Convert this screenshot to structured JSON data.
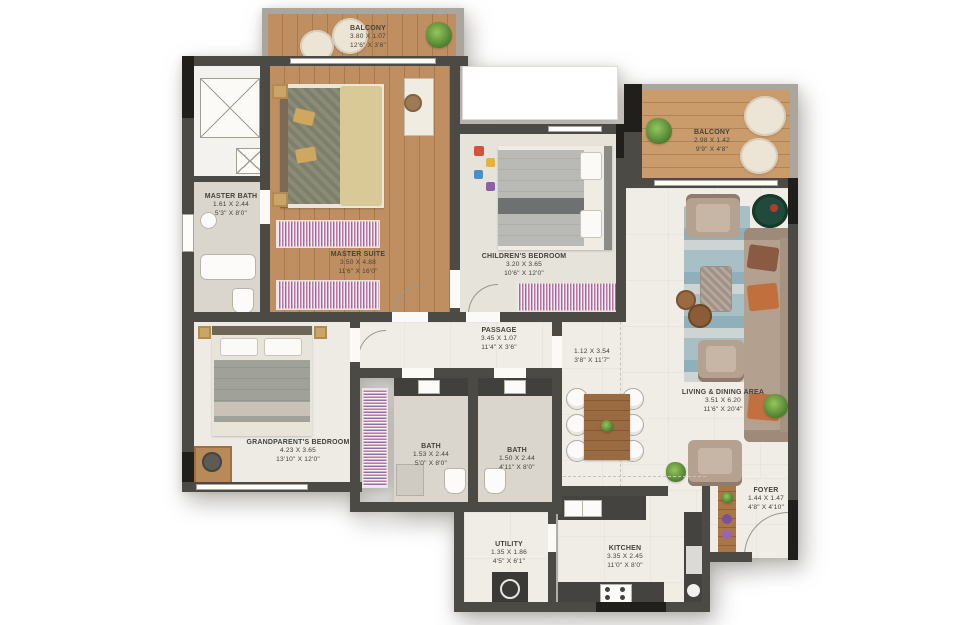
{
  "title": "Apartment floor plan",
  "palette": {
    "wall": "#4c4a45",
    "wall_column": "#201f1c",
    "parapet": "#aba69d",
    "wood_floor": "#bd8a5c",
    "light_floor": "#f0ede7",
    "bath_floor": "#dad6ce",
    "wardrobe_pink": "#c76f9d",
    "wardrobe_purple": "#8f6fae",
    "rug_blue": "#9ab4bd",
    "sofa_tan": "#b3a08f",
    "pillow_orange": "#c2703f",
    "plant_green": "#5d9136",
    "text": "#45423a"
  },
  "rooms": [
    {
      "id": "balcony-top-left",
      "name": "BALCONY",
      "metric": "3.80 X 1.07",
      "imperial": "12'6\" X 3'6\""
    },
    {
      "id": "master-bath",
      "name": "MASTER BATH",
      "metric": "1.61 X 2.44",
      "imperial": "5'3\" X 8'0\""
    },
    {
      "id": "master-suite",
      "name": "MASTER SUITE",
      "metric": "3.50 X 4.88",
      "imperial": "11'6\" X 16'0\""
    },
    {
      "id": "childrens-bedroom",
      "name": "CHILDREN'S BEDROOM",
      "metric": "3.20 X 3.65",
      "imperial": "10'6\" X 12'0\""
    },
    {
      "id": "balcony-top-right",
      "name": "BALCONY",
      "metric": "2.98 X 1.42",
      "imperial": "9'9\" X 4'8\""
    },
    {
      "id": "passage",
      "name": "PASSAGE",
      "metric": "3.45 X 1.07",
      "imperial": "11'4\" X 3'6\""
    },
    {
      "id": "corridor",
      "name": "",
      "metric": "1.12 X 3.54",
      "imperial": "3'8\" X 11'7\""
    },
    {
      "id": "living-dining",
      "name": "LIVING & DINING AREA",
      "metric": "3.51 X 6.20",
      "imperial": "11'6\" X 20'4\""
    },
    {
      "id": "grandparents-bedroom",
      "name": "GRANDPARENT'S BEDROOM",
      "metric": "4.23 X 3.65",
      "imperial": "13'10\" X 12'0\""
    },
    {
      "id": "bath-1",
      "name": "BATH",
      "metric": "1.53 X 2.44",
      "imperial": "5'0\" X 8'0\""
    },
    {
      "id": "bath-2",
      "name": "BATH",
      "metric": "1.50 X 2.44",
      "imperial": "4'11\" X 8'0\""
    },
    {
      "id": "utility",
      "name": "UTILITY",
      "metric": "1.35 X 1.86",
      "imperial": "4'5\" X 6'1\""
    },
    {
      "id": "kitchen",
      "name": "KITCHEN",
      "metric": "3.35 X 2.45",
      "imperial": "11'0\" X 8'0\""
    },
    {
      "id": "foyer",
      "name": "FOYER",
      "metric": "1.44 X 1.47",
      "imperial": "4'8\" X 4'10\""
    }
  ]
}
